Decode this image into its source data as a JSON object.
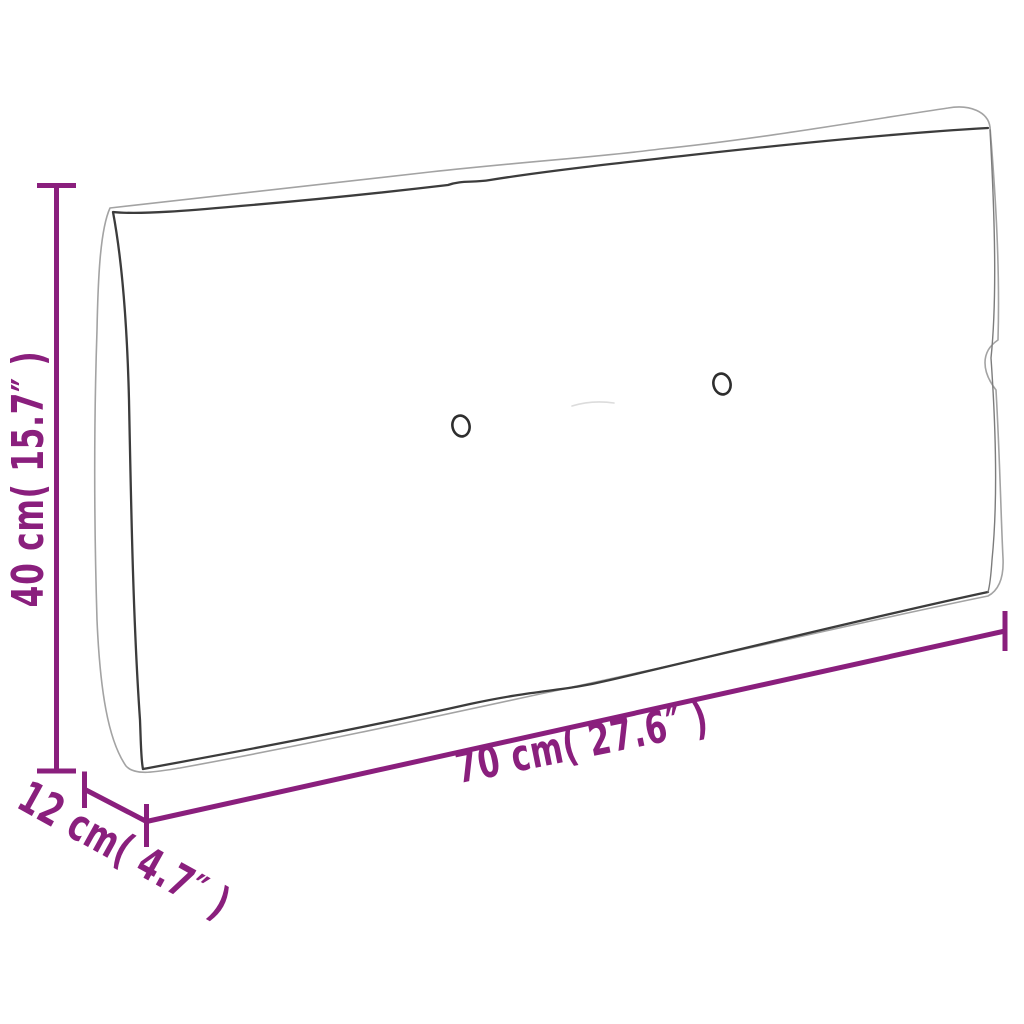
{
  "colors": {
    "background": "#ffffff",
    "accent": "#8a1f7d",
    "outline": "#a3a3a3",
    "seam": "#3c3c3c",
    "button": "#2e2e2e"
  },
  "diagram": {
    "labels": {
      "height": "40 cm( 15.7″ )",
      "width": "70 cm( 27.6″ )",
      "depth": "12 cm( 4.7″ )"
    },
    "dimensions": {
      "height": {
        "cm": 40,
        "inches": 15.7
      },
      "width": {
        "cm": 70,
        "inches": 27.6
      },
      "depth": {
        "cm": 12,
        "inches": 4.7
      }
    },
    "illustration": {
      "subject": "cushion-line-drawing",
      "button_count": 2
    }
  }
}
